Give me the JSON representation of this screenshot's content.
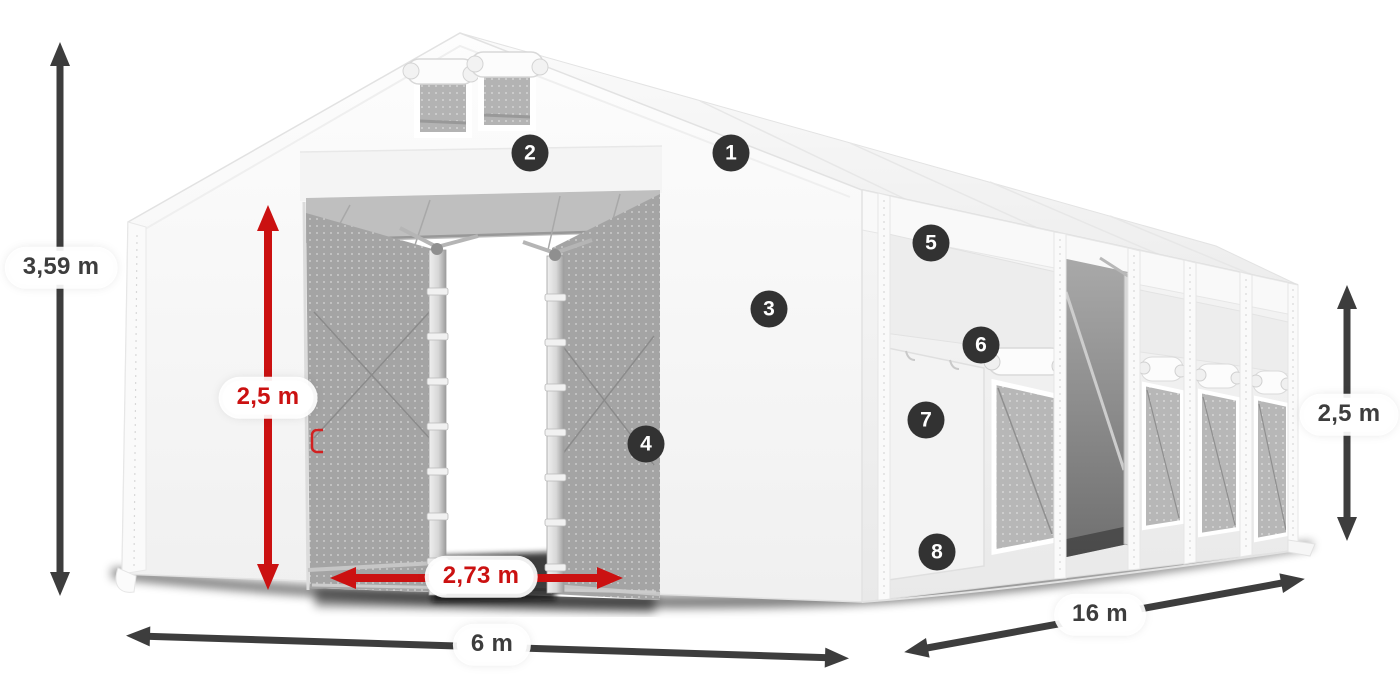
{
  "dimensions": {
    "total_height": {
      "label": "3,59 m",
      "color": "#3d3d3d"
    },
    "entrance_height": {
      "label": "2,5 m",
      "color": "#cb1111"
    },
    "entrance_width": {
      "label": "2,73 m",
      "color": "#cb1111"
    },
    "front_width": {
      "label": "6 m",
      "color": "#3d3d3d"
    },
    "side_length": {
      "label": "16 m",
      "color": "#3d3d3d"
    },
    "side_wall_height": {
      "label": "2,5 m",
      "color": "#3d3d3d"
    }
  },
  "callouts": [
    {
      "number": "1"
    },
    {
      "number": "2"
    },
    {
      "number": "3"
    },
    {
      "number": "4"
    },
    {
      "number": "5"
    },
    {
      "number": "6"
    },
    {
      "number": "7"
    },
    {
      "number": "8"
    }
  ],
  "colors": {
    "dimension_red": "#cb1111",
    "dimension_dark": "#3d3d3d",
    "callout_badge_bg": "#323232",
    "callout_badge_text": "#ffffff",
    "pill_bg": "#ffffff",
    "background": "#ffffff",
    "tent_white": "#f7f7f7",
    "mesh_gray": "#a4a4a4"
  }
}
